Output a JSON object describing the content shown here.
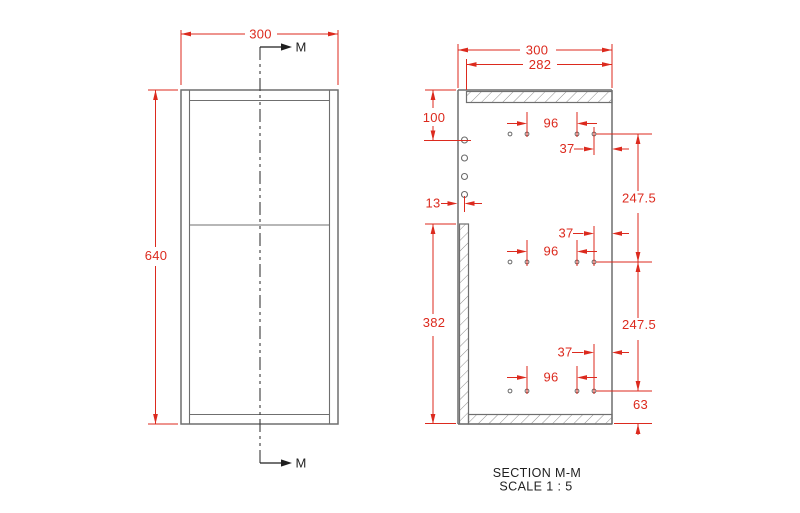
{
  "front_view": {
    "dim_width": "300",
    "dim_height": "640",
    "section_arrow_top": "M",
    "section_arrow_bottom": "M"
  },
  "section_view": {
    "title": "SECTION M-M",
    "scale_note": "SCALE 1 : 5",
    "dim_outer_width": "300",
    "dim_top_panel_width": "282",
    "dim_top_offset": "100",
    "dim_back_inset": "13",
    "dim_side_panel_height": "382",
    "dim_hole_spacing": "96",
    "dim_hole_edge_offset": "37",
    "dim_row_spacing": "247.5",
    "dim_bottom_offset": "63"
  },
  "colors": {
    "dimension_red": "#dc2a1e",
    "geometry_gray": "#6f6f6f",
    "annotation_black": "#1f1f1f"
  }
}
